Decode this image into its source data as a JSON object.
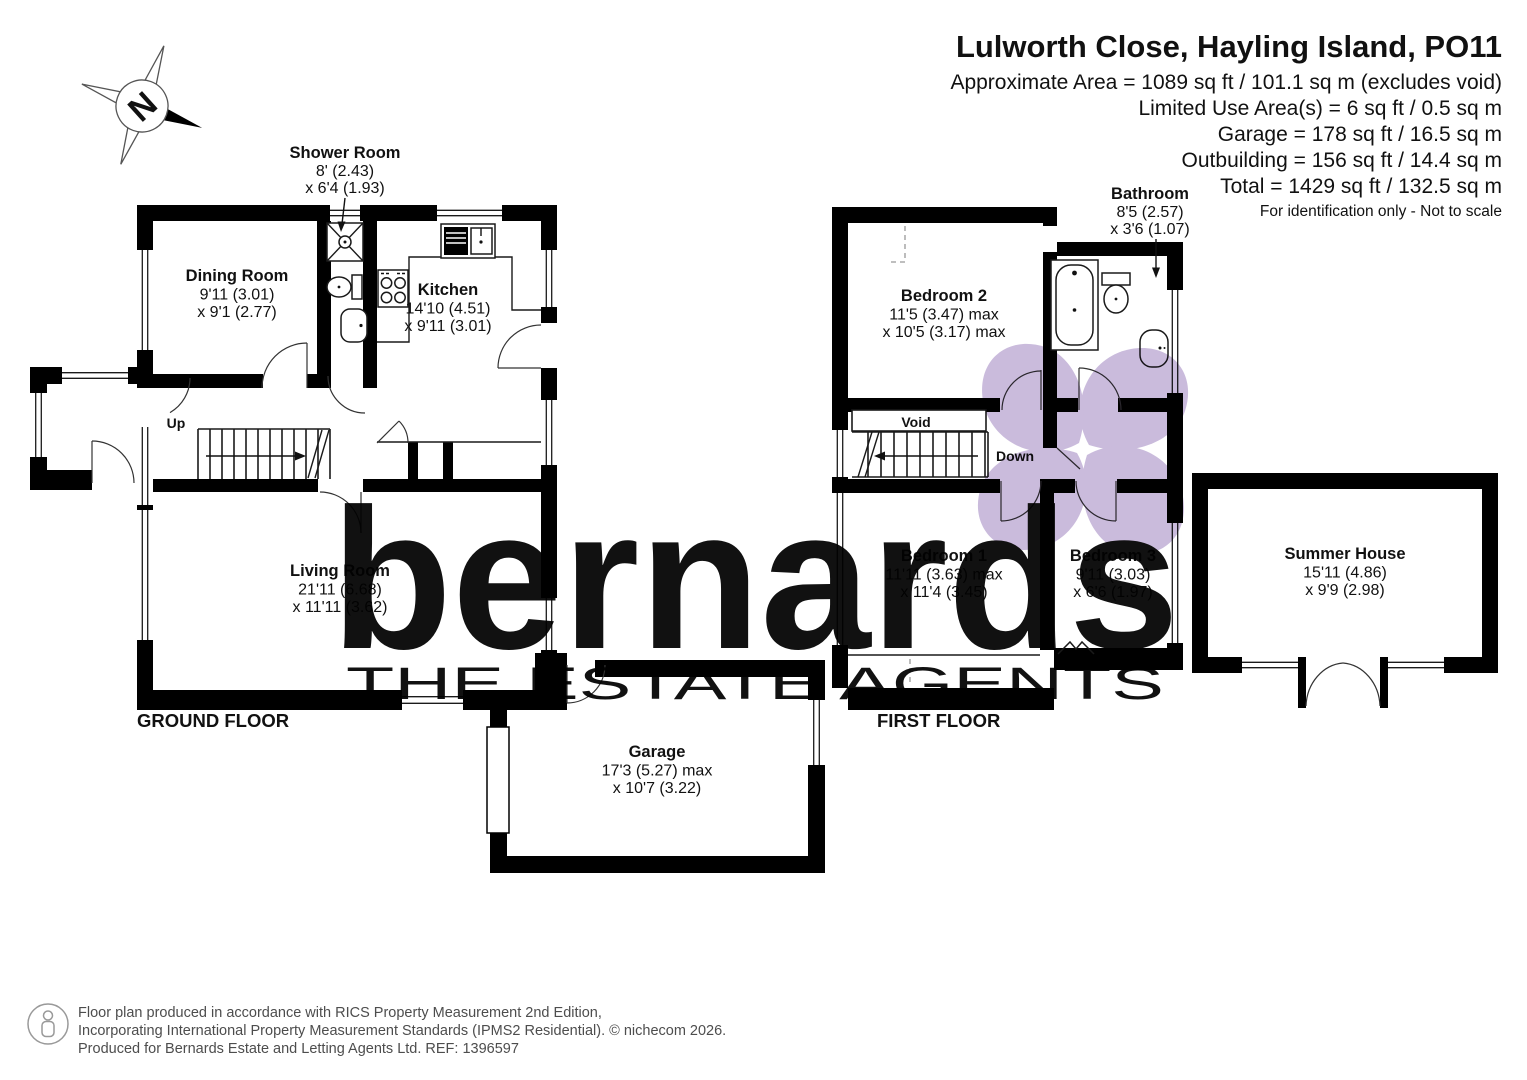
{
  "header": {
    "title": "Lulworth Close, Hayling Island, PO11",
    "lines": [
      "Approximate Area = 1089 sq ft / 101.1  sq m (excludes void)",
      "Limited Use Area(s) = 6 sq ft / 0.5 sq m",
      "Garage = 178 sq ft / 16.5 sq m",
      "Outbuilding = 156 sq ft / 14.4 sq m",
      "Total = 1429 sq ft / 132.5 sq m"
    ],
    "note": "For identification only - Not to scale"
  },
  "compass": {
    "label": "N"
  },
  "ground_floor": {
    "label": "GROUND FLOOR",
    "stairs_label": "Up",
    "rooms": {
      "dining": {
        "name": "Dining Room",
        "dim1": "9'11 (3.01)",
        "dim2": "x 9'1 (2.77)"
      },
      "shower": {
        "name": "Shower Room",
        "dim1": "8' (2.43)",
        "dim2": "x 6'4 (1.93)"
      },
      "kitchen": {
        "name": "Kitchen",
        "dim1": "14'10 (4.51)",
        "dim2": "x 9'11 (3.01)"
      },
      "living": {
        "name": "Living Room",
        "dim1": "21'11 (6.68)",
        "dim2": "x 11'11 (3.62)"
      }
    }
  },
  "first_floor": {
    "label": "FIRST FLOOR",
    "stairs_label": "Down",
    "void_label": "Void",
    "rooms": {
      "bedroom2": {
        "name": "Bedroom 2",
        "dim1": "11'5 (3.47) max",
        "dim2": "x 10'5 (3.17) max"
      },
      "bathroom": {
        "name": "Bathroom",
        "dim1": "8'5 (2.57)",
        "dim2": "x 3'6 (1.07)"
      },
      "bedroom1": {
        "name": "Bedroom 1",
        "dim1": "11'11 (3.63) max",
        "dim2": "x 11'4 (3.45)"
      },
      "bedroom3": {
        "name": "Bedroom 3",
        "dim1": "9'11 (3.03)",
        "dim2": "x 6'6 (1.97)"
      }
    }
  },
  "outbuildings": {
    "garage": {
      "name": "Garage",
      "dim1": "17'3 (5.27) max",
      "dim2": "x 10'7 (3.22)"
    },
    "summer_house": {
      "name": "Summer House",
      "dim1": "15'11 (4.86)",
      "dim2": "x 9'9 (2.98)"
    }
  },
  "watermark": {
    "brand": "bernards",
    "tagline": "THE ESTATE AGENTS",
    "brand_color": "#c6b6d7",
    "petal_color": "#cabbdc",
    "tagline_color": "#d2d2d2"
  },
  "footer": {
    "line1": "Floor plan produced in accordance with RICS Property Measurement 2nd Edition,",
    "line2": "Incorporating International Property Measurement Standards (IPMS2 Residential).   © nichecom 2026.",
    "line3": "Produced for Bernards Estate and Letting Agents Ltd.   REF:  1396597"
  }
}
